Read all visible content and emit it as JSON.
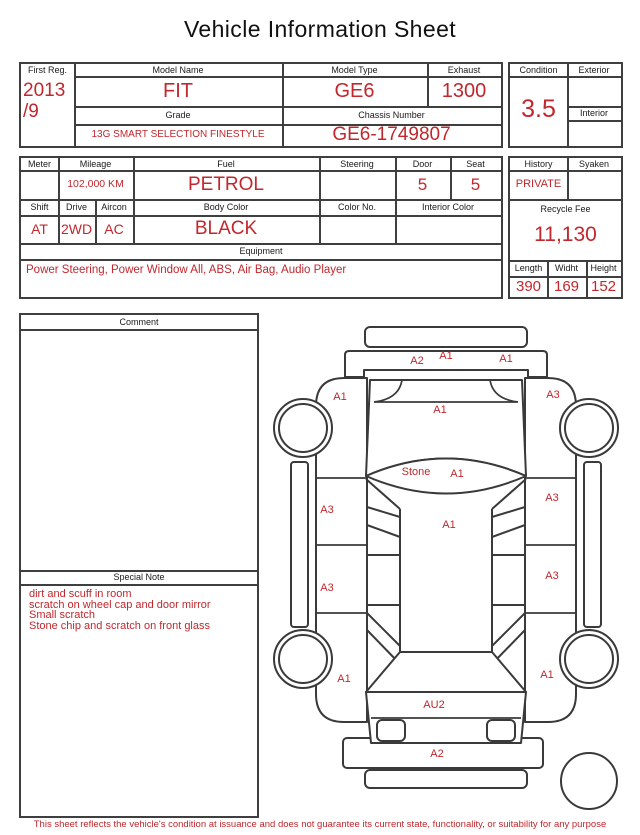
{
  "title": "Vehicle Information Sheet",
  "accent_color": "#c1272d",
  "top_table": {
    "first_reg_label": "First Reg.",
    "first_reg_line1": "2013",
    "first_reg_line2": "/9",
    "model_name_label": "Model Name",
    "model_name": "FIT",
    "model_type_label": "Model Type",
    "model_type": "GE6",
    "exhaust_label": "Exhaust",
    "exhaust": "1300",
    "grade_label": "Grade",
    "grade": "13G SMART SELECTION FINESTYLE",
    "chassis_label": "Chassis Number",
    "chassis": "GE6-1749807"
  },
  "condition_box": {
    "condition_label": "Condition",
    "condition": "3.5",
    "exterior_label": "Exterior",
    "exterior": "",
    "interior_label": "Interior",
    "interior": ""
  },
  "spec_table": {
    "meter_label": "Meter",
    "meter": "",
    "mileage_label": "Mileage",
    "mileage": "102,000 KM",
    "fuel_label": "Fuel",
    "fuel": "PETROL",
    "steering_label": "Steering",
    "steering": "",
    "door_label": "Door",
    "door": "5",
    "seat_label": "Seat",
    "seat": "5",
    "shift_label": "Shift",
    "shift": "AT",
    "drive_label": "Drive",
    "drive": "2WD",
    "aircon_label": "Aircon",
    "aircon": "AC",
    "body_color_label": "Body Color",
    "body_color": "BLACK",
    "color_no_label": "Color No.",
    "color_no": "",
    "interior_color_label": "Interior Color",
    "interior_color": "",
    "equipment_label": "Equipment",
    "equipment": "Power Steering, Power Window  All, ABS, Air Bag, Audio Player"
  },
  "history_box": {
    "history_label": "History",
    "history": "PRIVATE",
    "syaken_label": "Syaken",
    "syaken": "",
    "recycle_fee_label": "Recycle Fee",
    "recycle_fee": "11,130",
    "length_label": "Length",
    "length": "390",
    "width_label": "Widht",
    "width": "169",
    "height_label": "Height",
    "height": "152"
  },
  "comment_box": {
    "label": "Comment",
    "value": ""
  },
  "special_note": {
    "label": "Special Note",
    "lines": [
      "dirt and scuff in room",
      "scratch on wheel cap and door mirror",
      "Small scratch",
      "Stone chip and scratch on front glass"
    ]
  },
  "damage_diagram": {
    "labels": [
      {
        "text": "A2",
        "x": 147,
        "y": 51
      },
      {
        "text": "A1",
        "x": 176,
        "y": 46
      },
      {
        "text": "A1",
        "x": 236,
        "y": 49
      },
      {
        "text": "A1",
        "x": 70,
        "y": 87
      },
      {
        "text": "A3",
        "x": 283,
        "y": 85
      },
      {
        "text": "A1",
        "x": 170,
        "y": 100
      },
      {
        "text": "Stone",
        "x": 146,
        "y": 162
      },
      {
        "text": "A1",
        "x": 187,
        "y": 164
      },
      {
        "text": "A3",
        "x": 57,
        "y": 200
      },
      {
        "text": "A3",
        "x": 282,
        "y": 188
      },
      {
        "text": "A1",
        "x": 179,
        "y": 215
      },
      {
        "text": "A3",
        "x": 57,
        "y": 278
      },
      {
        "text": "A3",
        "x": 282,
        "y": 266
      },
      {
        "text": "A1",
        "x": 74,
        "y": 369
      },
      {
        "text": "A1",
        "x": 277,
        "y": 365
      },
      {
        "text": "AU2",
        "x": 164,
        "y": 395
      },
      {
        "text": "A2",
        "x": 167,
        "y": 444
      }
    ]
  },
  "footer": "This sheet reflects the vehicle's condition at issuance and does not guarantee its current state, functionality, or suitability for any purpose"
}
